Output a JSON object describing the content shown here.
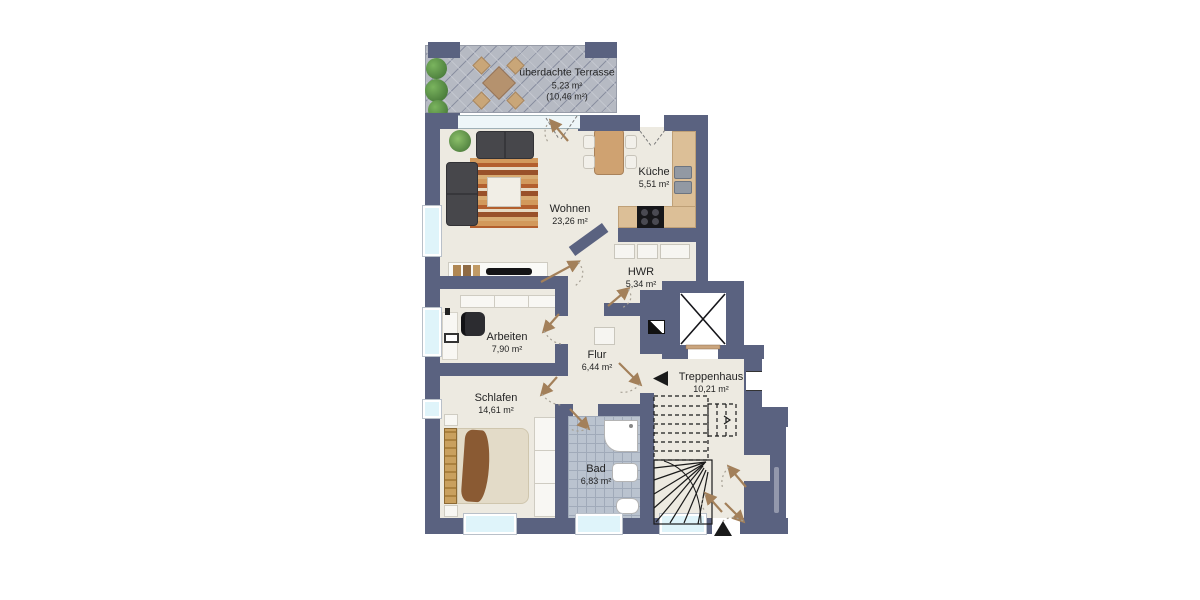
{
  "plan": {
    "type": "apartment-floor-plan",
    "language": "de"
  },
  "rooms": [
    {
      "id": "terrasse",
      "label": "überdachte Terrasse",
      "area": "5,23 m²",
      "area_full": "(10,46 m²)"
    },
    {
      "id": "wohnen",
      "label": "Wohnen",
      "area": "23,26 m²"
    },
    {
      "id": "kueche",
      "label": "Küche",
      "area": "5,51 m²"
    },
    {
      "id": "hwr",
      "label": "HWR",
      "area": "5,34 m²"
    },
    {
      "id": "arbeiten",
      "label": "Arbeiten",
      "area": "7,90 m²"
    },
    {
      "id": "flur",
      "label": "Flur",
      "area": "6,44 m²"
    },
    {
      "id": "treppenhaus",
      "label": "Treppenhaus",
      "area": "10,21 m²"
    },
    {
      "id": "schlafen",
      "label": "Schlafen",
      "area": "14,61 m²"
    },
    {
      "id": "bad",
      "label": "Bad",
      "area": "6,83 m²"
    }
  ],
  "colors": {
    "wall": "#5a6280",
    "floor": "#edeae1",
    "terrace_tile": "#b6bac3",
    "bath_tile": "#bac3cf",
    "window_glass": "#dff4fa",
    "counter_wood": "#dcbf97",
    "door_arrow": "#a3805a",
    "sofa": "#47474b",
    "plant": "#4f7f3b",
    "bed_blanket": "#8a5a33",
    "text": "#242424"
  }
}
